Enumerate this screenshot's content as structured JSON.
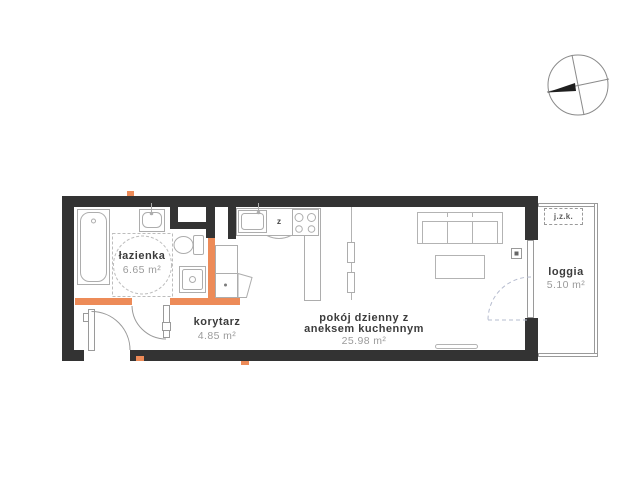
{
  "plan": {
    "title": "studio apartment floor plan",
    "rooms": [
      {
        "name": "łazienka",
        "area": "6.65 m²"
      },
      {
        "name": "korytarz",
        "area": "4.85 m²"
      },
      {
        "name_line1": "pokój dzienny z",
        "name_line2": "aneksem kuchennym",
        "area": "25.98 m²"
      },
      {
        "name": "loggia",
        "area": "5.10 m²"
      }
    ],
    "annotations": {
      "ac_outdoor_unit": "j.z.k.",
      "dishwasher": "z"
    },
    "icons": {
      "compass": "north-compass-rose",
      "ac_marker": "square-with-dot"
    },
    "colors": {
      "wall": "#333333",
      "accent_orange": "#ed8b58",
      "fixture_line": "#adadad",
      "swing_dashed": "#b6bccf",
      "text_dark": "#3c3c3c",
      "text_gray": "#9b9b9b"
    }
  }
}
